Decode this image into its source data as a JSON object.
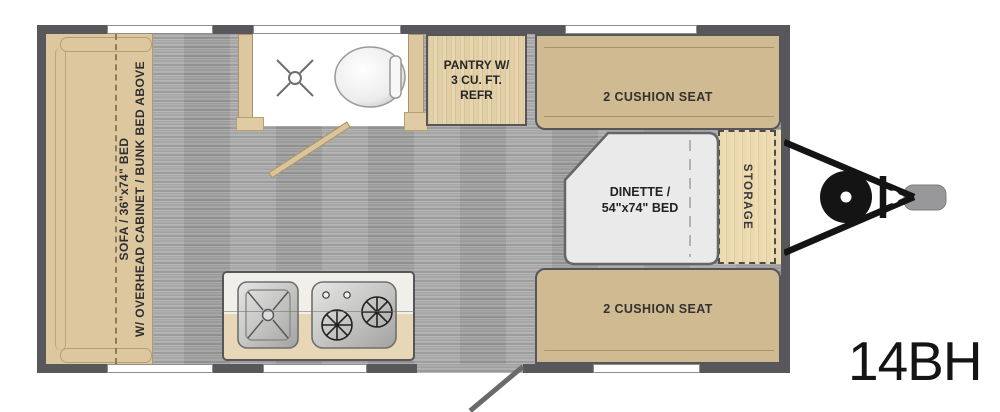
{
  "model": "14BH",
  "labels": {
    "sofa_line1": "SOFA / 36\"x74\" BED",
    "sofa_line2": "W/ OVERHEAD CABINET / BUNK BED ABOVE",
    "pantry_line1": "PANTRY W/",
    "pantry_line2": "3 CU. FT.",
    "pantry_line3": "REFR",
    "seat_front": "2 CUSHION SEAT",
    "seat_rear": "2 CUSHION SEAT",
    "dinette_line1": "DINETTE /",
    "dinette_line2": "54\"x74\" BED",
    "storage": "STORAGE"
  },
  "colors": {
    "wall": "#58585c",
    "floor": "#a6a6a6",
    "sofa": "#dcc79f",
    "seat": "#cfba92",
    "pantry": "#e2cfa6",
    "storage": "#ecd9ae",
    "dinette_table": "#eaeaea",
    "bathroom": "#ffffff",
    "counter_top": "#f1efe9",
    "counter_base": "#e7d7b7",
    "hitch": "#141414",
    "coupler": "#98989a"
  }
}
